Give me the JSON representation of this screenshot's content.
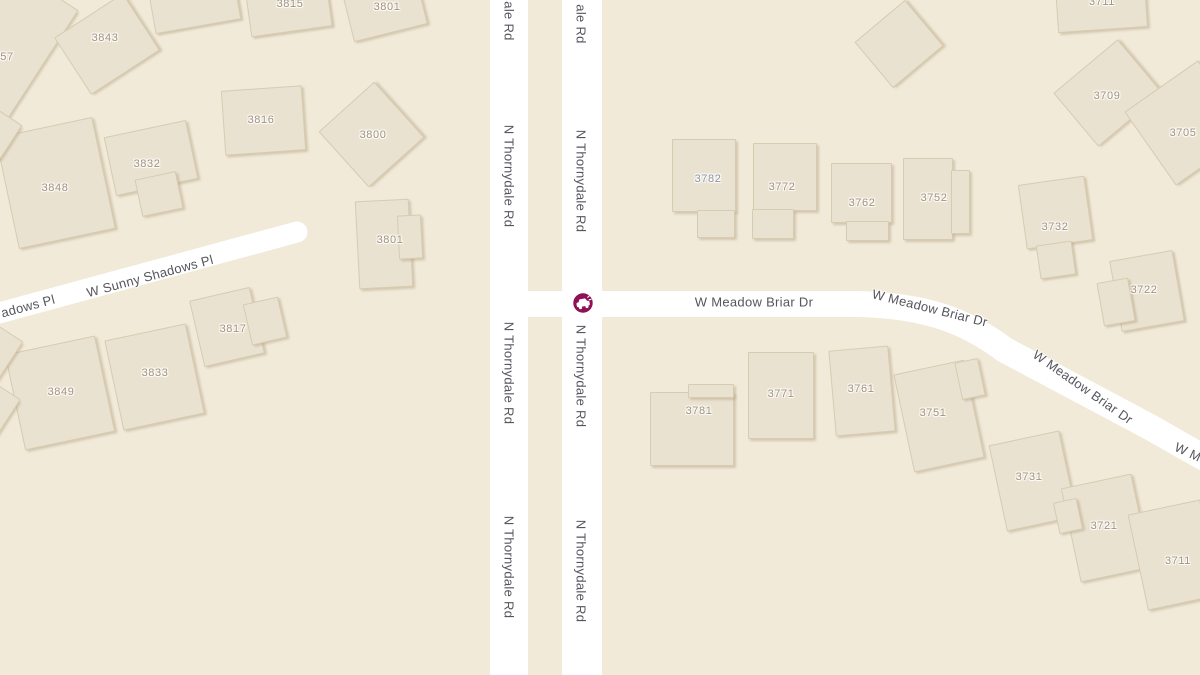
{
  "map": {
    "colors": {
      "background": "#f1ead9",
      "road": "#ffffff",
      "building_fill": "#eae2d1",
      "building_border": "#d7cbb1",
      "building_shadow": "rgba(178,158,124,0.45)",
      "road_label_text": "#56555d",
      "house_number_text": "#a1937d",
      "house_number_alt_text": "#8c95a4",
      "incident_accent": "#8e1254"
    },
    "incident": {
      "type": "crash",
      "icon": "car-crash-icon",
      "x": 583,
      "y": 303
    },
    "roads": [
      {
        "id": "n-thornydale-rd-west",
        "name": "N Thornydale Rd",
        "d": "M 509 -10 L 509 685",
        "width": 38,
        "cap": "butt"
      },
      {
        "id": "n-thornydale-rd-east",
        "name": "N Thornydale Rd",
        "d": "M 582 -10 L 582 685",
        "width": 40,
        "cap": "butt"
      },
      {
        "id": "w-meadow-briar-dr",
        "name": "W Meadow Briar Dr",
        "d": "M 505 304 L 860 304 C 925 306 965 320 1005 350 L 1148 426 C 1166 436 1182 446 1212 462",
        "width": 26,
        "cap": "butt"
      },
      {
        "id": "w-sunny-shadows-pl",
        "name": "W Sunny Shadows Pl",
        "d": "M -12 316 L 297 232",
        "width": 21,
        "cap": "round"
      }
    ],
    "road_labels": [
      {
        "text": "ale Rd",
        "x": 509,
        "y": 21,
        "rot": 90
      },
      {
        "text": "ale Rd",
        "x": 581,
        "y": 24,
        "rot": 90
      },
      {
        "text": "N Thornydale Rd",
        "x": 509,
        "y": 176,
        "rot": 90
      },
      {
        "text": "N Thornydale Rd",
        "x": 581,
        "y": 181,
        "rot": 90
      },
      {
        "text": "N Thornydale Rd",
        "x": 509,
        "y": 373,
        "rot": 90
      },
      {
        "text": "N Thornydale Rd",
        "x": 581,
        "y": 376,
        "rot": 90
      },
      {
        "text": "N Thornydale Rd",
        "x": 509,
        "y": 567,
        "rot": 90
      },
      {
        "text": "N Thornydale Rd",
        "x": 581,
        "y": 571,
        "rot": 90
      },
      {
        "text": "W Meadow Briar Dr",
        "x": 754,
        "y": 302,
        "rot": 0
      },
      {
        "text": "W Meadow Briar Dr",
        "x": 930,
        "y": 308,
        "rot": 14
      },
      {
        "text": "W Meadow Briar Dr",
        "x": 1083,
        "y": 387,
        "rot": 35
      },
      {
        "text": "W M",
        "x": 1188,
        "y": 452,
        "rot": 25
      },
      {
        "text": "W Sunny Shadows Pl",
        "x": 150,
        "y": 276,
        "rot": -15
      },
      {
        "text": "adows Pl",
        "x": 28,
        "y": 306,
        "rot": -15
      }
    ],
    "house_numbers": [
      {
        "text": "57",
        "x": 7,
        "y": 57
      },
      {
        "text": "3843",
        "x": 105,
        "y": 38
      },
      {
        "text": "3815",
        "x": 290,
        "y": 4
      },
      {
        "text": "3801",
        "x": 387,
        "y": 7
      },
      {
        "text": "3816",
        "x": 261,
        "y": 120
      },
      {
        "text": "3800",
        "x": 373,
        "y": 135
      },
      {
        "text": "3832",
        "x": 147,
        "y": 164
      },
      {
        "text": "3848",
        "x": 55,
        "y": 188
      },
      {
        "text": "3801",
        "x": 390,
        "y": 240
      },
      {
        "text": "3817",
        "x": 233,
        "y": 329
      },
      {
        "text": "3833",
        "x": 155,
        "y": 373
      },
      {
        "text": "3849",
        "x": 61,
        "y": 392
      },
      {
        "text": "3782",
        "x": 708,
        "y": 179,
        "alt": true
      },
      {
        "text": "3772",
        "x": 782,
        "y": 187
      },
      {
        "text": "3762",
        "x": 862,
        "y": 203
      },
      {
        "text": "3752",
        "x": 934,
        "y": 198
      },
      {
        "text": "3732",
        "x": 1055,
        "y": 227
      },
      {
        "text": "3709",
        "x": 1107,
        "y": 96
      },
      {
        "text": "3705",
        "x": 1183,
        "y": 133
      },
      {
        "text": "3722",
        "x": 1144,
        "y": 290
      },
      {
        "text": "3711",
        "x": 1102,
        "y": 2
      },
      {
        "text": "3781",
        "x": 699,
        "y": 411
      },
      {
        "text": "3771",
        "x": 781,
        "y": 394
      },
      {
        "text": "3761",
        "x": 861,
        "y": 389
      },
      {
        "text": "3751",
        "x": 933,
        "y": 413
      },
      {
        "text": "3731",
        "x": 1029,
        "y": 477
      },
      {
        "text": "3721",
        "x": 1104,
        "y": 526
      },
      {
        "text": "3711",
        "x": 1178,
        "y": 561
      }
    ],
    "buildings": [
      {
        "id": "bldg-3857",
        "parts": [
          {
            "x": -58,
            "y": -30,
            "w": 108,
            "h": 128,
            "r": 33
          }
        ]
      },
      {
        "id": "bldg-top-mid",
        "parts": [
          {
            "x": 150,
            "y": -30,
            "w": 85,
            "h": 55,
            "r": -10
          }
        ]
      },
      {
        "id": "bldg-3815",
        "parts": [
          {
            "x": 247,
            "y": -26,
            "w": 80,
            "h": 56,
            "r": -8
          }
        ]
      },
      {
        "id": "bldg-3801-n",
        "parts": [
          {
            "x": 345,
            "y": -32,
            "w": 74,
            "h": 64,
            "r": -14
          }
        ]
      },
      {
        "id": "bldg-3843",
        "parts": [
          {
            "x": 66,
            "y": 10,
            "w": 80,
            "h": 66,
            "r": -33
          }
        ]
      },
      {
        "id": "bldg-3816",
        "parts": [
          {
            "x": 223,
            "y": 88,
            "w": 79,
            "h": 63,
            "r": -4
          }
        ]
      },
      {
        "id": "bldg-3800",
        "parts": [
          {
            "x": 334,
            "y": 97,
            "w": 73,
            "h": 73,
            "r": -42
          }
        ]
      },
      {
        "id": "bldg-3832",
        "parts": [
          {
            "x": 109,
            "y": 128,
            "w": 82,
            "h": 58,
            "r": -12
          },
          {
            "x": 138,
            "y": 175,
            "w": 40,
            "h": 36,
            "r": -12
          }
        ]
      },
      {
        "id": "bldg-3848",
        "parts": [
          {
            "x": 6,
            "y": 126,
            "w": 97,
            "h": 112,
            "r": -12
          }
        ]
      },
      {
        "id": "bldg-sliver-1",
        "parts": [
          {
            "x": -16,
            "y": 114,
            "w": 28,
            "h": 38,
            "r": 33
          }
        ]
      },
      {
        "id": "bldg-3801-m",
        "parts": [
          {
            "x": 357,
            "y": 200,
            "w": 52,
            "h": 86,
            "r": -3
          },
          {
            "x": 398,
            "y": 215,
            "w": 22,
            "h": 42,
            "r": -3
          }
        ]
      },
      {
        "id": "bldg-3817",
        "parts": [
          {
            "x": 196,
            "y": 293,
            "w": 60,
            "h": 66,
            "r": -13
          },
          {
            "x": 247,
            "y": 300,
            "w": 34,
            "h": 40,
            "r": -13
          }
        ]
      },
      {
        "id": "bldg-3833",
        "parts": [
          {
            "x": 113,
            "y": 331,
            "w": 81,
            "h": 90,
            "r": -12
          }
        ]
      },
      {
        "id": "bldg-3849",
        "parts": [
          {
            "x": 14,
            "y": 344,
            "w": 90,
            "h": 96,
            "r": -12
          }
        ]
      },
      {
        "id": "bldg-sliver-2",
        "parts": [
          {
            "x": -16,
            "y": 330,
            "w": 26,
            "h": 48,
            "r": 33
          }
        ]
      },
      {
        "id": "bldg-sliver-3",
        "parts": [
          {
            "x": -18,
            "y": 388,
            "w": 26,
            "h": 46,
            "r": 33
          }
        ]
      },
      {
        "id": "bldg-diamond",
        "parts": [
          {
            "x": 866,
            "y": 14,
            "w": 64,
            "h": 58,
            "r": -40
          }
        ]
      },
      {
        "id": "bldg-3711-n",
        "parts": [
          {
            "x": 1056,
            "y": -30,
            "w": 88,
            "h": 58,
            "r": -4
          }
        ]
      },
      {
        "id": "bldg-3709",
        "parts": [
          {
            "x": 1066,
            "y": 58,
            "w": 82,
            "h": 68,
            "r": -40
          }
        ]
      },
      {
        "id": "bldg-3705",
        "parts": [
          {
            "x": 1142,
            "y": 78,
            "w": 88,
            "h": 88,
            "r": -35
          }
        ]
      },
      {
        "id": "bldg-3732",
        "parts": [
          {
            "x": 1022,
            "y": 180,
            "w": 65,
            "h": 63,
            "r": -8
          },
          {
            "x": 1038,
            "y": 243,
            "w": 34,
            "h": 32,
            "r": -8
          }
        ]
      },
      {
        "id": "bldg-3722",
        "parts": [
          {
            "x": 1115,
            "y": 255,
            "w": 62,
            "h": 70,
            "r": -10
          },
          {
            "x": 1100,
            "y": 280,
            "w": 30,
            "h": 42,
            "r": -10
          }
        ]
      },
      {
        "id": "bldg-3782",
        "parts": [
          {
            "x": 672,
            "y": 139,
            "w": 62,
            "h": 71,
            "r": 0
          },
          {
            "x": 697,
            "y": 210,
            "w": 36,
            "h": 26,
            "r": 0
          }
        ]
      },
      {
        "id": "bldg-3772",
        "parts": [
          {
            "x": 753,
            "y": 143,
            "w": 62,
            "h": 66,
            "r": 0
          },
          {
            "x": 752,
            "y": 209,
            "w": 40,
            "h": 28,
            "r": 0
          }
        ]
      },
      {
        "id": "bldg-3762",
        "parts": [
          {
            "x": 831,
            "y": 163,
            "w": 59,
            "h": 58,
            "r": 0
          },
          {
            "x": 846,
            "y": 221,
            "w": 41,
            "h": 18,
            "r": 0
          }
        ]
      },
      {
        "id": "bldg-3752",
        "parts": [
          {
            "x": 903,
            "y": 158,
            "w": 48,
            "h": 80,
            "r": 0
          },
          {
            "x": 951,
            "y": 170,
            "w": 17,
            "h": 62,
            "r": 0
          }
        ]
      },
      {
        "id": "bldg-3781",
        "parts": [
          {
            "x": 650,
            "y": 392,
            "w": 82,
            "h": 72,
            "r": 0
          },
          {
            "x": 688,
            "y": 384,
            "w": 44,
            "h": 12,
            "r": 0
          }
        ]
      },
      {
        "id": "bldg-3771",
        "parts": [
          {
            "x": 748,
            "y": 352,
            "w": 64,
            "h": 85,
            "r": 0
          }
        ]
      },
      {
        "id": "bldg-3761",
        "parts": [
          {
            "x": 832,
            "y": 348,
            "w": 58,
            "h": 84,
            "r": -5
          }
        ]
      },
      {
        "id": "bldg-3751",
        "parts": [
          {
            "x": 903,
            "y": 366,
            "w": 70,
            "h": 98,
            "r": -12
          },
          {
            "x": 958,
            "y": 360,
            "w": 22,
            "h": 36,
            "r": -12
          }
        ]
      },
      {
        "id": "bldg-3731",
        "parts": [
          {
            "x": 997,
            "y": 437,
            "w": 70,
            "h": 86,
            "r": -12
          }
        ]
      },
      {
        "id": "bldg-3721",
        "parts": [
          {
            "x": 1070,
            "y": 480,
            "w": 70,
            "h": 94,
            "r": -12
          },
          {
            "x": 1056,
            "y": 500,
            "w": 22,
            "h": 30,
            "r": -12
          }
        ]
      },
      {
        "id": "bldg-3711-s",
        "parts": [
          {
            "x": 1137,
            "y": 506,
            "w": 72,
            "h": 96,
            "r": -12
          }
        ]
      }
    ]
  }
}
